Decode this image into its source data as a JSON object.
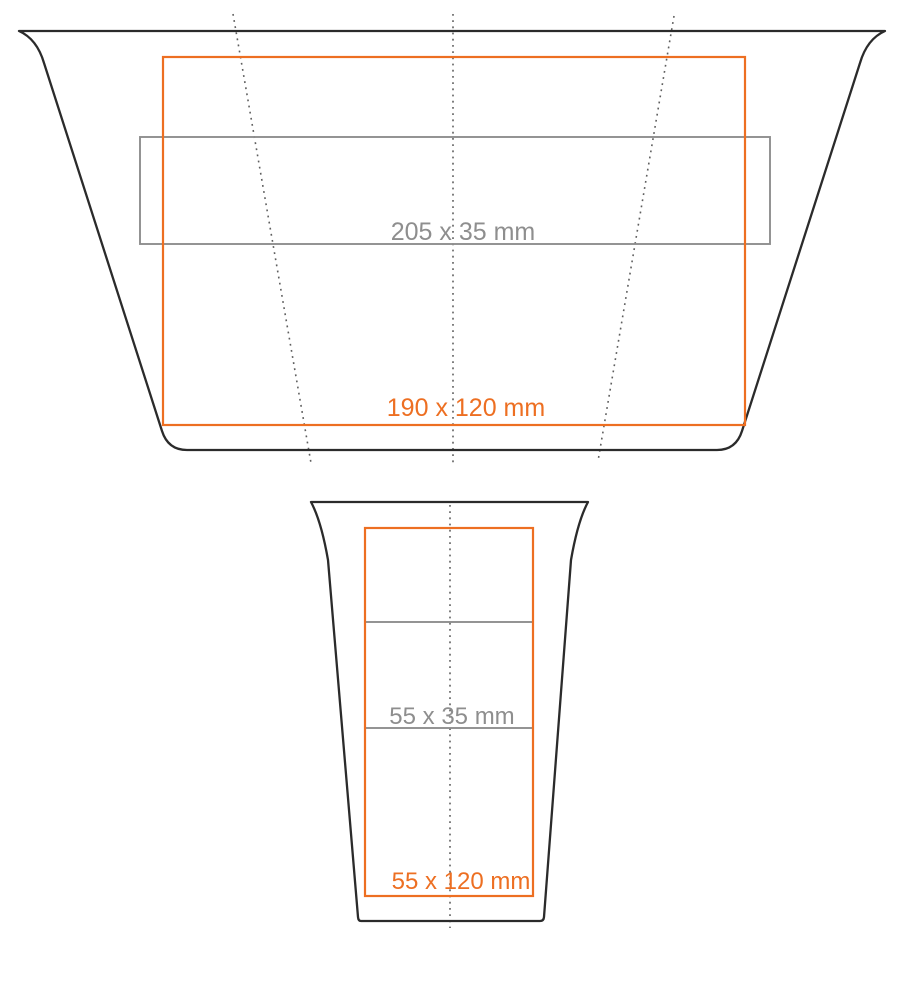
{
  "diagram_title": "cup-print-area-template",
  "colors": {
    "background": "#ffffff",
    "outline": "#2b2b2b",
    "accent_orange": "#ed6f22",
    "gray": "#8e8e8e",
    "dotted": "#5f5f5f"
  },
  "top_view": {
    "description": "unfolded-cup-wrap",
    "print_area_label": "190 x 120 mm",
    "engraving_area_label": "205 x 35 mm"
  },
  "front_view": {
    "description": "cup-front",
    "print_area_label": "55 x 120 mm",
    "engraving_area_label": "55 x 35 mm"
  }
}
